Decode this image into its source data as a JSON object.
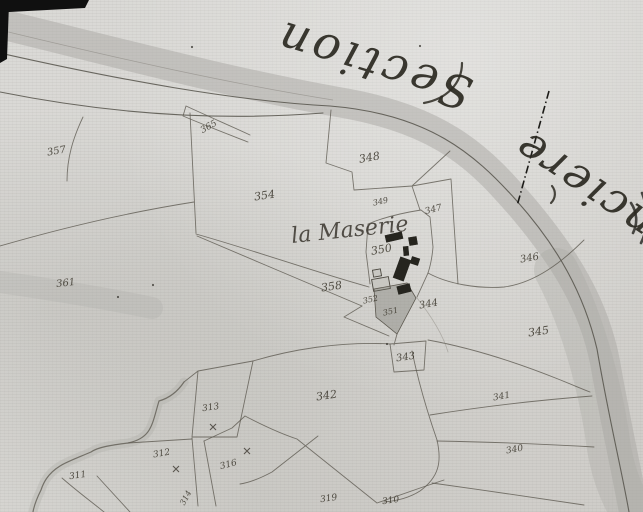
{
  "canvas": {
    "width": 643,
    "height": 512
  },
  "titles": {
    "section": "Section",
    "adjacent_territory": "anciere",
    "place": "la Maserie"
  },
  "colors": {
    "paper": "#d5d4d0",
    "ink": "#4a463d",
    "boundary": "#5b574e",
    "river_wash": "#a9a8a3",
    "building": "#26251f"
  },
  "parcel_labels": [
    {
      "n": "365",
      "x": 210,
      "y": 129,
      "r": -30,
      "s": 9
    },
    {
      "n": "357",
      "x": 57,
      "y": 154,
      "r": -10,
      "s": 10
    },
    {
      "n": "361",
      "x": 66,
      "y": 286,
      "r": -6,
      "s": 10
    },
    {
      "n": "348",
      "x": 370,
      "y": 161,
      "r": -10,
      "s": 11
    },
    {
      "n": "354",
      "x": 265,
      "y": 199,
      "r": -8,
      "s": 11
    },
    {
      "n": "349",
      "x": 381,
      "y": 204,
      "r": -12,
      "s": 8
    },
    {
      "n": "347",
      "x": 434,
      "y": 212,
      "r": -14,
      "s": 9
    },
    {
      "n": "350",
      "x": 382,
      "y": 253,
      "r": -10,
      "s": 11
    },
    {
      "n": "346",
      "x": 530,
      "y": 261,
      "r": -10,
      "s": 10
    },
    {
      "n": "358",
      "x": 332,
      "y": 290,
      "r": -8,
      "s": 11
    },
    {
      "n": "352",
      "x": 371,
      "y": 302,
      "r": -12,
      "s": 8
    },
    {
      "n": "351",
      "x": 391,
      "y": 314,
      "r": -12,
      "s": 8
    },
    {
      "n": "344",
      "x": 429,
      "y": 307,
      "r": -10,
      "s": 10
    },
    {
      "n": "345",
      "x": 539,
      "y": 335,
      "r": -8,
      "s": 11
    },
    {
      "n": "343",
      "x": 406,
      "y": 360,
      "r": -8,
      "s": 10
    },
    {
      "n": "342",
      "x": 327,
      "y": 399,
      "r": -8,
      "s": 11
    },
    {
      "n": "341",
      "x": 502,
      "y": 399,
      "r": -10,
      "s": 9
    },
    {
      "n": "340",
      "x": 515,
      "y": 452,
      "r": -10,
      "s": 9
    },
    {
      "n": "313",
      "x": 211,
      "y": 410,
      "r": -8,
      "s": 9
    },
    {
      "n": "312",
      "x": 162,
      "y": 456,
      "r": -10,
      "s": 9
    },
    {
      "n": "316",
      "x": 229,
      "y": 467,
      "r": -14,
      "s": 9
    },
    {
      "n": "311",
      "x": 78,
      "y": 478,
      "r": -8,
      "s": 9
    },
    {
      "n": "314",
      "x": 188,
      "y": 499,
      "r": -62,
      "s": 8
    },
    {
      "n": "319",
      "x": 329,
      "y": 501,
      "r": -8,
      "s": 9
    },
    {
      "n": "310",
      "x": 391,
      "y": 503,
      "r": -8,
      "s": 9
    }
  ],
  "x_marks": [
    {
      "x": 213,
      "y": 427
    },
    {
      "x": 176,
      "y": 469
    },
    {
      "x": 247,
      "y": 451
    }
  ],
  "dots": [
    {
      "x": 192,
      "y": 47
    },
    {
      "x": 118,
      "y": 297
    },
    {
      "x": 153,
      "y": 285
    },
    {
      "x": 387,
      "y": 344
    },
    {
      "x": 420,
      "y": 46
    }
  ],
  "buildings_filled": [
    {
      "cx": 394,
      "cy": 237,
      "w": 17,
      "h": 7,
      "r": -13
    },
    {
      "cx": 413,
      "cy": 241,
      "w": 8,
      "h": 8,
      "r": -10
    },
    {
      "cx": 406,
      "cy": 251,
      "w": 5,
      "h": 9,
      "r": -5
    },
    {
      "cx": 402,
      "cy": 269,
      "w": 11,
      "h": 22,
      "r": 20
    },
    {
      "cx": 415,
      "cy": 261,
      "w": 8,
      "h": 7,
      "r": 18
    },
    {
      "cx": 404,
      "cy": 289,
      "w": 13,
      "h": 8,
      "r": -14
    }
  ],
  "buildings_outlined": [
    {
      "cx": 381,
      "cy": 284,
      "w": 17,
      "h": 12,
      "r": -10
    },
    {
      "cx": 377,
      "cy": 273,
      "w": 8,
      "h": 7,
      "r": -10
    }
  ],
  "shaded_parcel_points": "374,289 407,283 416,298 397,334 376,317"
}
